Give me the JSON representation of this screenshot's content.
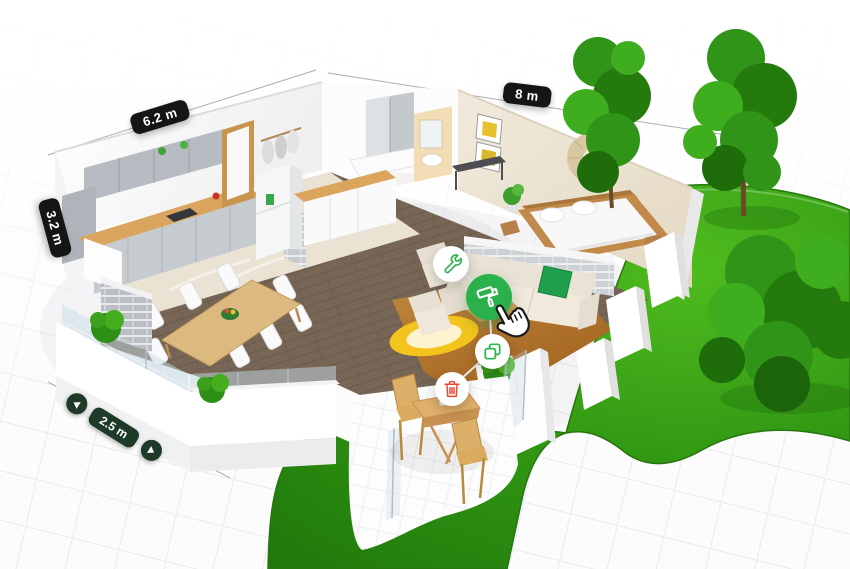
{
  "scene": {
    "description": "3D isometric floor plan of a one-bedroom house with garden",
    "rooms": [
      "kitchen",
      "bathroom",
      "hallway",
      "bedroom",
      "living-room",
      "dining-room",
      "terrace",
      "patio"
    ],
    "garden_elements": [
      "lawn",
      "trees",
      "bushes",
      "outdoor-dining-set"
    ]
  },
  "dimensions": {
    "top_left": {
      "text": "6.2 m"
    },
    "top_right": {
      "text": "8 m"
    },
    "left": {
      "text": "3.2 m"
    },
    "bottom": {
      "text": "2.5 m",
      "has_stepper_arrows": true
    }
  },
  "tools": {
    "buttons": [
      {
        "id": "adjust",
        "icon": "wrench-icon",
        "shape": "white-circle",
        "icon_color": "#2eb34f"
      },
      {
        "id": "paint",
        "icon": "paint-roller-icon",
        "shape": "green-circle",
        "background": "#2bb14c",
        "icon_color": "#ffffff",
        "active": true
      },
      {
        "id": "duplicate",
        "icon": "copy-icon",
        "shape": "white-circle",
        "icon_color": "#2eb34f"
      },
      {
        "id": "delete",
        "icon": "trash-icon",
        "shape": "white-circle",
        "icon_color": "#e8472e"
      }
    ]
  },
  "cursor": {
    "type": "hand-pointer"
  },
  "colors": {
    "accent_green": "#2bb14c",
    "delete_red": "#e8472e",
    "badge_black": "#151515",
    "badge_dark_green": "#1e3a28",
    "lawn_green": "#2f9212"
  }
}
